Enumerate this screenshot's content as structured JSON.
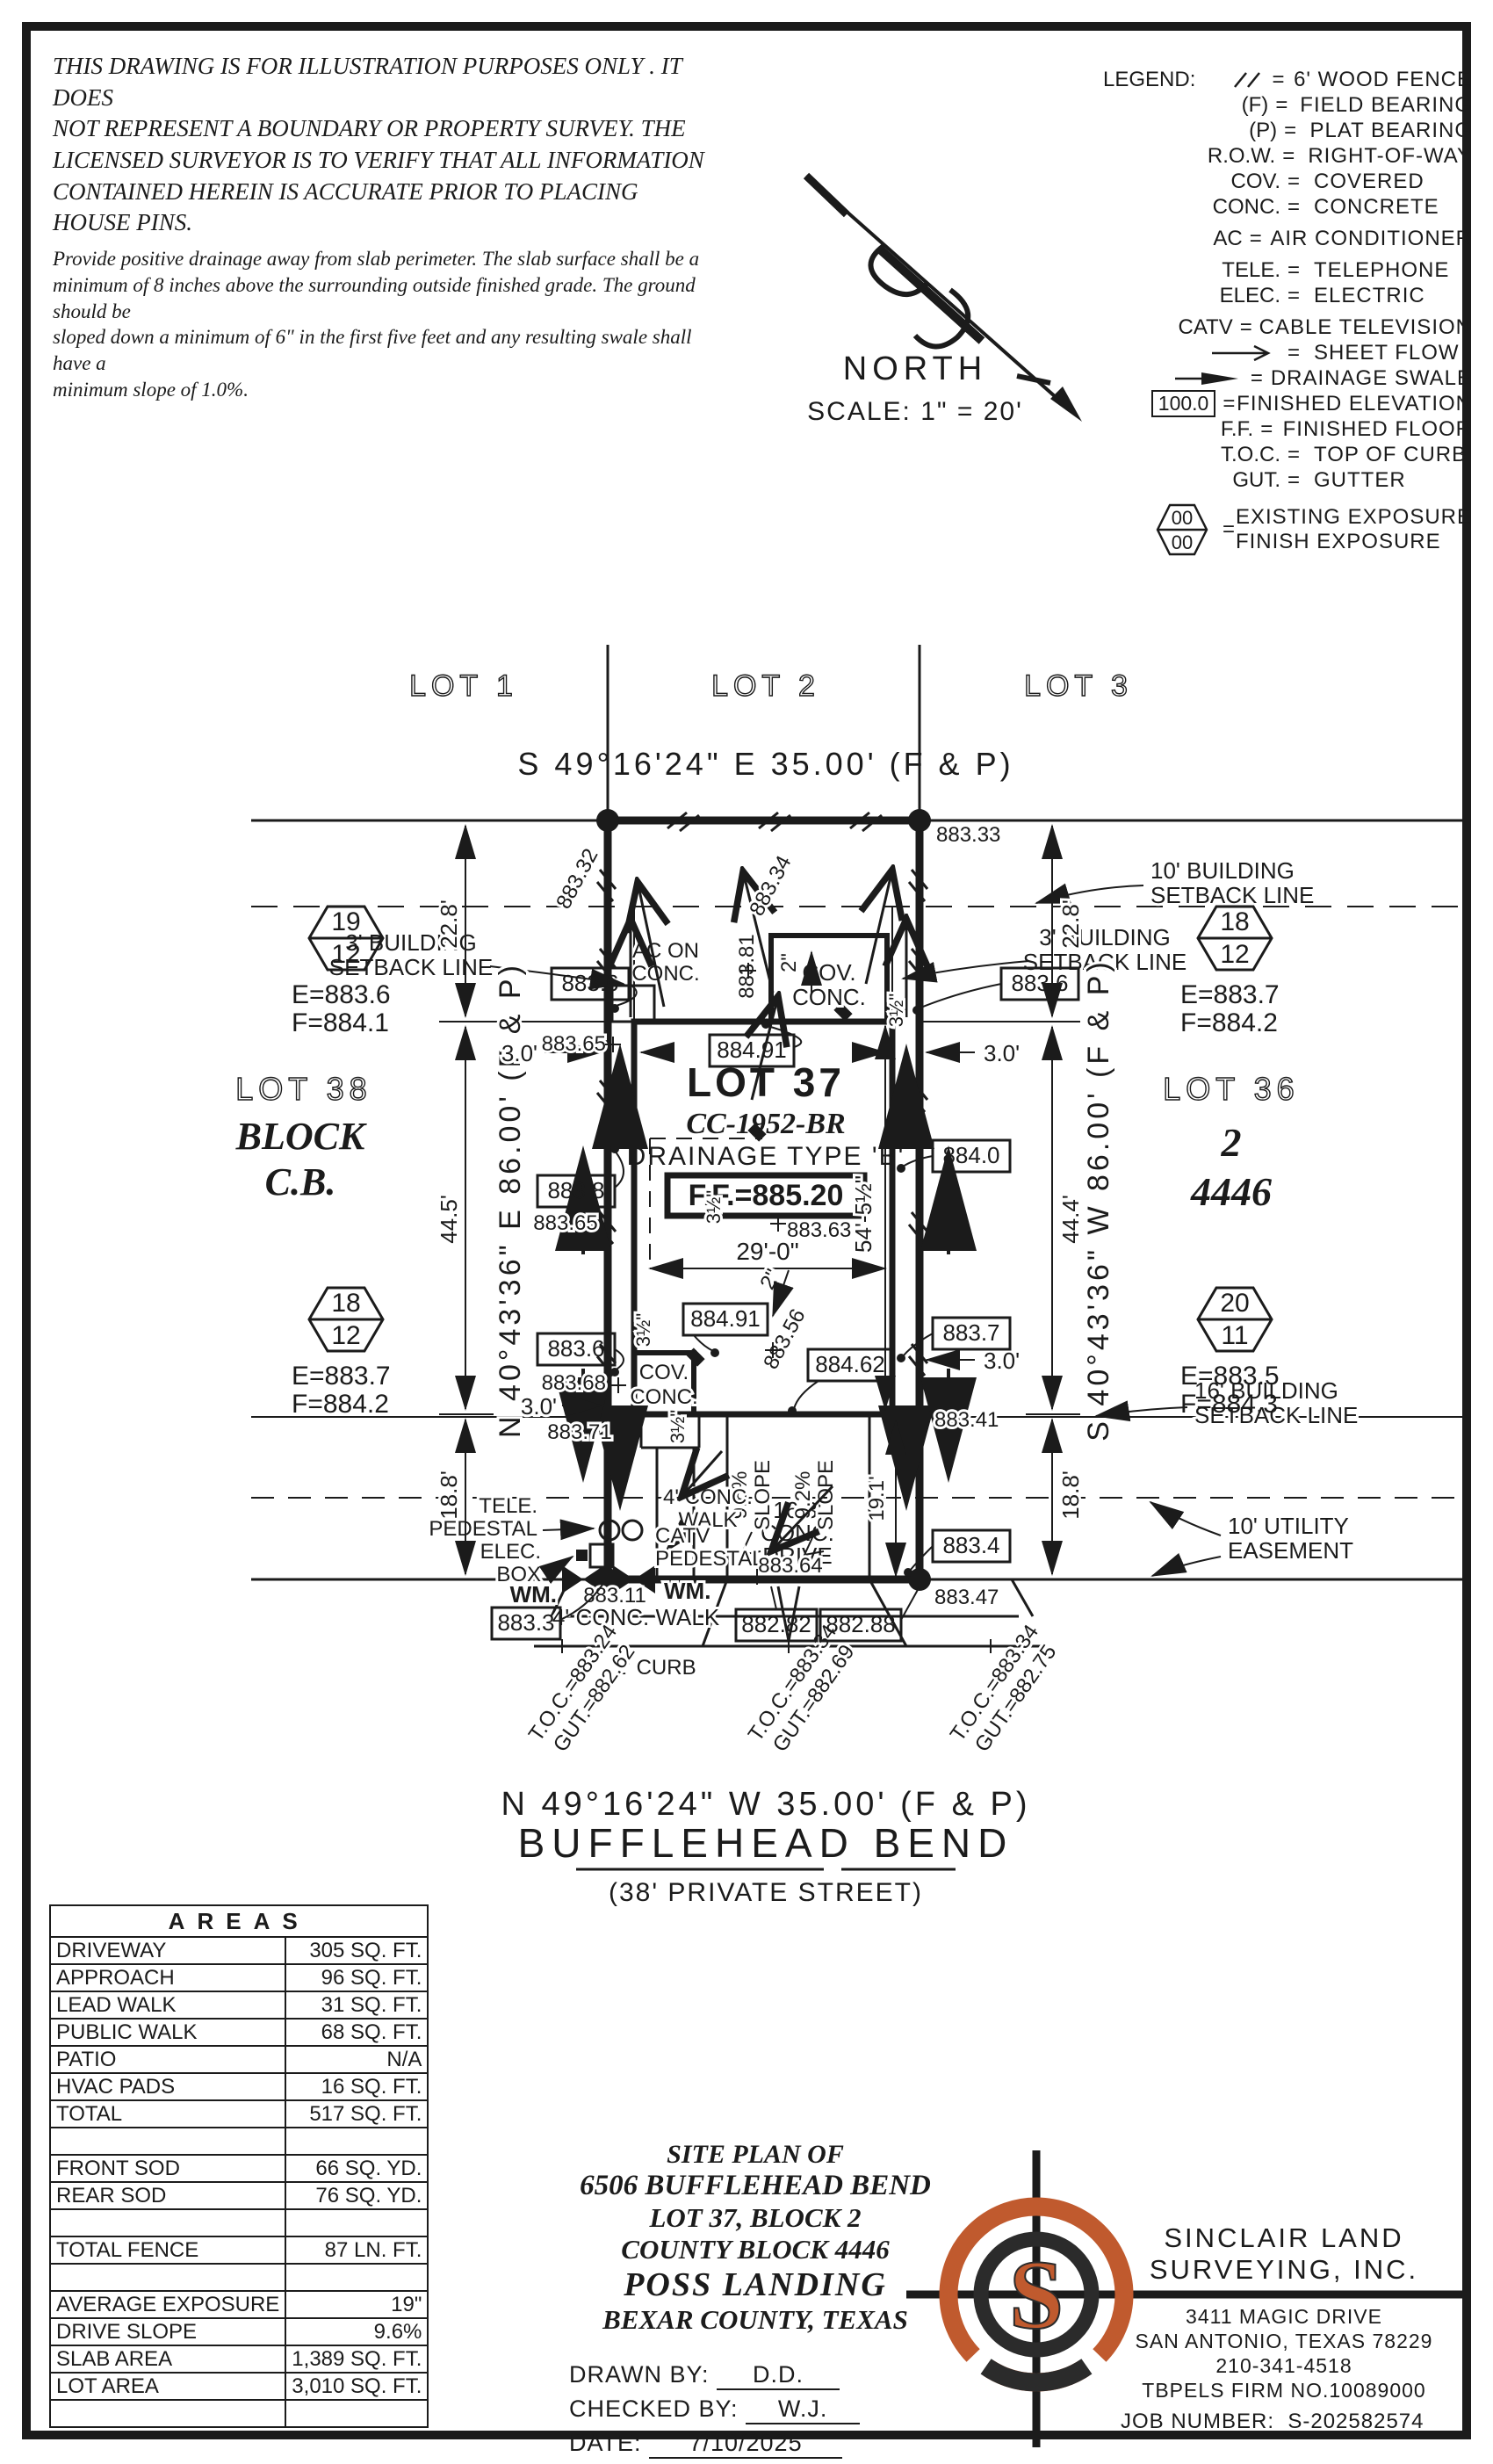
{
  "disclaimer": {
    "p1l1": "THIS DRAWING IS FOR ILLUSTRATION PURPOSES ONLY . IT DOES",
    "p1l2": "NOT REPRESENT A BOUNDARY OR PROPERTY SURVEY. THE",
    "p1l3": "LICENSED SURVEYOR IS TO VERIFY THAT ALL INFORMATION",
    "p1l4": "CONTAINED HEREIN IS ACCURATE PRIOR TO PLACING HOUSE PINS.",
    "p2l1": "Provide positive drainage away from slab perimeter. The slab surface shall be a",
    "p2l2": "minimum of 8 inches above the surrounding outside finished grade. The ground should be",
    "p2l3": "sloped down a minimum of 6\" in the first five feet and any resulting swale shall have a",
    "p2l4": "minimum slope of 1.0%."
  },
  "legend": {
    "title": "LEGEND:",
    "eq": "=",
    "box_value": "100.0",
    "hex_top": "00",
    "hex_bottom": "00",
    "rows": [
      {
        "abbr": "",
        "desc": "6' WOOD FENCE"
      },
      {
        "abbr": "(F)",
        "desc": "FIELD BEARING"
      },
      {
        "abbr": "(P)",
        "desc": "PLAT BEARING"
      },
      {
        "abbr": "R.O.W.",
        "desc": "RIGHT-OF-WAY"
      },
      {
        "abbr": "COV.",
        "desc": "COVERED"
      },
      {
        "abbr": "CONC.",
        "desc": "CONCRETE"
      },
      {
        "abbr": "AC",
        "desc": "AIR CONDITIONER"
      },
      {
        "abbr": "TELE.",
        "desc": "TELEPHONE"
      },
      {
        "abbr": "ELEC.",
        "desc": "ELECTRIC"
      },
      {
        "abbr": "CATV",
        "desc": "CABLE TELEVISION"
      },
      {
        "abbr": "",
        "desc": "SHEET FLOW"
      },
      {
        "abbr": "",
        "desc": "DRAINAGE SWALE"
      },
      {
        "abbr": "",
        "desc": "FINISHED ELEVATION"
      },
      {
        "abbr": "F.F.",
        "desc": "FINISHED FLOOR"
      },
      {
        "abbr": "T.O.C.",
        "desc": "TOP OF CURB"
      },
      {
        "abbr": "GUT.",
        "desc": "GUTTER"
      },
      {
        "abbr": "",
        "desc": "EXISTING EXPOSURE"
      },
      {
        "abbr": "",
        "desc": "FINISH EXPOSURE"
      }
    ]
  },
  "north": {
    "label": "NORTH",
    "scale": "SCALE: 1\" = 20'"
  },
  "plan": {
    "lots_top": [
      "LOT 1",
      "LOT 2",
      "LOT 3"
    ],
    "bearing_top": "S 49°16'24\" E 35.00' (F & P)",
    "bearing_bottom": "N 49°16'24\" W 35.00' (F & P)",
    "bearing_left": "N 40°43'36\" E 86.00' (F & P)",
    "bearing_right": "S 40°43'36\" W 86.00' (F & P)",
    "street_name": "BUFFLEHEAD BEND",
    "street_sub": "(38' PRIVATE STREET)",
    "lot37": {
      "name": "LOT 37",
      "plan_no": "CC-1952-BR",
      "drainage": "DRAINAGE TYPE 'B'",
      "ff": "F.F.=885.20"
    },
    "lot38": {
      "l1": "LOT 38",
      "l2": "BLOCK",
      "l3": "C.B."
    },
    "lot36": {
      "l1": "LOT 36",
      "l2": "2",
      "l3": "4446"
    },
    "hex": [
      {
        "top": "19",
        "bottom": "12",
        "e": "E=883.6",
        "f": "F=884.1"
      },
      {
        "top": "18",
        "bottom": "12",
        "e": "E=883.7",
        "f": "F=884.2"
      },
      {
        "top": "18",
        "bottom": "12",
        "e": "E=883.7",
        "f": "F=884.2"
      },
      {
        "top": "20",
        "bottom": "11",
        "e": "E=883.5",
        "f": "F=884.3"
      }
    ],
    "setbacks": {
      "s3a": "3' BUILDING",
      "s3b": "SETBACK LINE",
      "s10a": "10' BUILDING",
      "s10b": "SETBACK LINE",
      "s16a": "16' BUILDING",
      "s16b": "SETBACK LINE",
      "uea": "10' UTILITY",
      "ueb": "EASEMENT"
    },
    "labels": {
      "ac1": "AC ON",
      "ac2": "CONC.",
      "cov1": "COV.",
      "cov2": "CONC.",
      "tele": "TELE.",
      "ped": "PEDESTAL",
      "elec": "ELEC.",
      "box": "BOX",
      "wm": "WM.",
      "catv": "CATV",
      "catv2": "PEDESTAL",
      "walk1": "4' CONC.",
      "walk2": "WALK",
      "walk_b": "4' CONC. WALK",
      "curb": "2' CURB",
      "drive1": "16.3'",
      "drive2": "CONC.",
      "drive3": "DRIVE",
      "slope1": "9.6%",
      "slope2": "9.2%",
      "slope_w": "SLOPE"
    },
    "dims": {
      "d228": "22.8'",
      "d445": "44.5'",
      "d444": "44.4'",
      "d188": "18.8'",
      "d30": "3.0'",
      "d290": "29'-0\"",
      "d545": "54'-5½\"",
      "d191": "19.1'",
      "d2": "2\"",
      "d35": "3½\""
    },
    "boxed": {
      "b1": "883.6",
      "b2": "883.6",
      "b3": "884.91",
      "b4": "883.8",
      "b5": "883.6",
      "b6": "884.91",
      "b7": "884.62",
      "b8": "884.0",
      "b9": "883.7",
      "b10": "883.4",
      "b11": "883.3",
      "b12": "882.82",
      "b13": "882.88"
    },
    "spots": {
      "s883_32": "883.32",
      "s883_34": "883.34",
      "s883_33": "883.33",
      "s883_65a": "883.65",
      "s883_65b": "883.65",
      "s883_68": "883.68",
      "s883_71": "883.71",
      "s883_81": "883.81",
      "s883_63": "883.63",
      "s883_56": "883.56",
      "s883_41": "883.41",
      "s883_64": "883.64",
      "s883_11": "883.11",
      "s883_47": "883.47"
    },
    "toc": {
      "t1a": "T.O.C.=883.24",
      "t1b": "GUT.=882.62",
      "t2a": "T.O.C.=883.34",
      "t2b": "GUT.=882.69",
      "t3a": "T.O.C.=883.34",
      "t3b": "GUT.=882.75"
    }
  },
  "areas": {
    "title": "AREAS",
    "rows": [
      {
        "l": "DRIVEWAY",
        "v": "305 SQ. FT."
      },
      {
        "l": "APPROACH",
        "v": "96 SQ. FT."
      },
      {
        "l": "LEAD WALK",
        "v": "31 SQ. FT."
      },
      {
        "l": "PUBLIC WALK",
        "v": "68 SQ. FT."
      },
      {
        "l": "PATIO",
        "v": "N/A"
      },
      {
        "l": "HVAC PADS",
        "v": "16 SQ. FT."
      },
      {
        "l": "TOTAL",
        "v": "517 SQ. FT."
      },
      {
        "l": "",
        "v": ""
      },
      {
        "l": "FRONT SOD",
        "v": "66 SQ. YD."
      },
      {
        "l": "REAR SOD",
        "v": "76 SQ. YD."
      },
      {
        "l": "",
        "v": ""
      },
      {
        "l": "TOTAL FENCE",
        "v": "87 LN. FT."
      },
      {
        "l": "",
        "v": ""
      },
      {
        "l": "AVERAGE EXPOSURE",
        "v": "19\""
      },
      {
        "l": "DRIVE SLOPE",
        "v": "9.6%"
      },
      {
        "l": "SLAB AREA",
        "v": "1,389 SQ. FT."
      },
      {
        "l": "LOT AREA",
        "v": "3,010 SQ. FT."
      },
      {
        "l": "",
        "v": ""
      }
    ]
  },
  "titleblock": {
    "l1": "SITE PLAN OF",
    "l2": "6506 BUFFLEHEAD BEND",
    "l3": "LOT 37, BLOCK 2",
    "l4": "COUNTY BLOCK 4446",
    "l5": "POSS LANDING",
    "l6": "BEXAR COUNTY, TEXAS",
    "drawn_label": "DRAWN BY:",
    "drawn": "D.D.",
    "checked_label": "CHECKED BY:",
    "checked": "W.J.",
    "date_label": "DATE:",
    "date": "7/10/2025"
  },
  "firm": {
    "name1": "SINCLAIR LAND",
    "name2": "SURVEYING, INC.",
    "addr1": "3411 MAGIC DRIVE",
    "addr2": "SAN ANTONIO, TEXAS 78229",
    "phone": "210-341-4518",
    "reg": "TBPELS FIRM NO.10089000",
    "job_label": "JOB NUMBER:",
    "job": "S-202582574",
    "logo_letter": "S",
    "orange": "#c05a2e"
  }
}
